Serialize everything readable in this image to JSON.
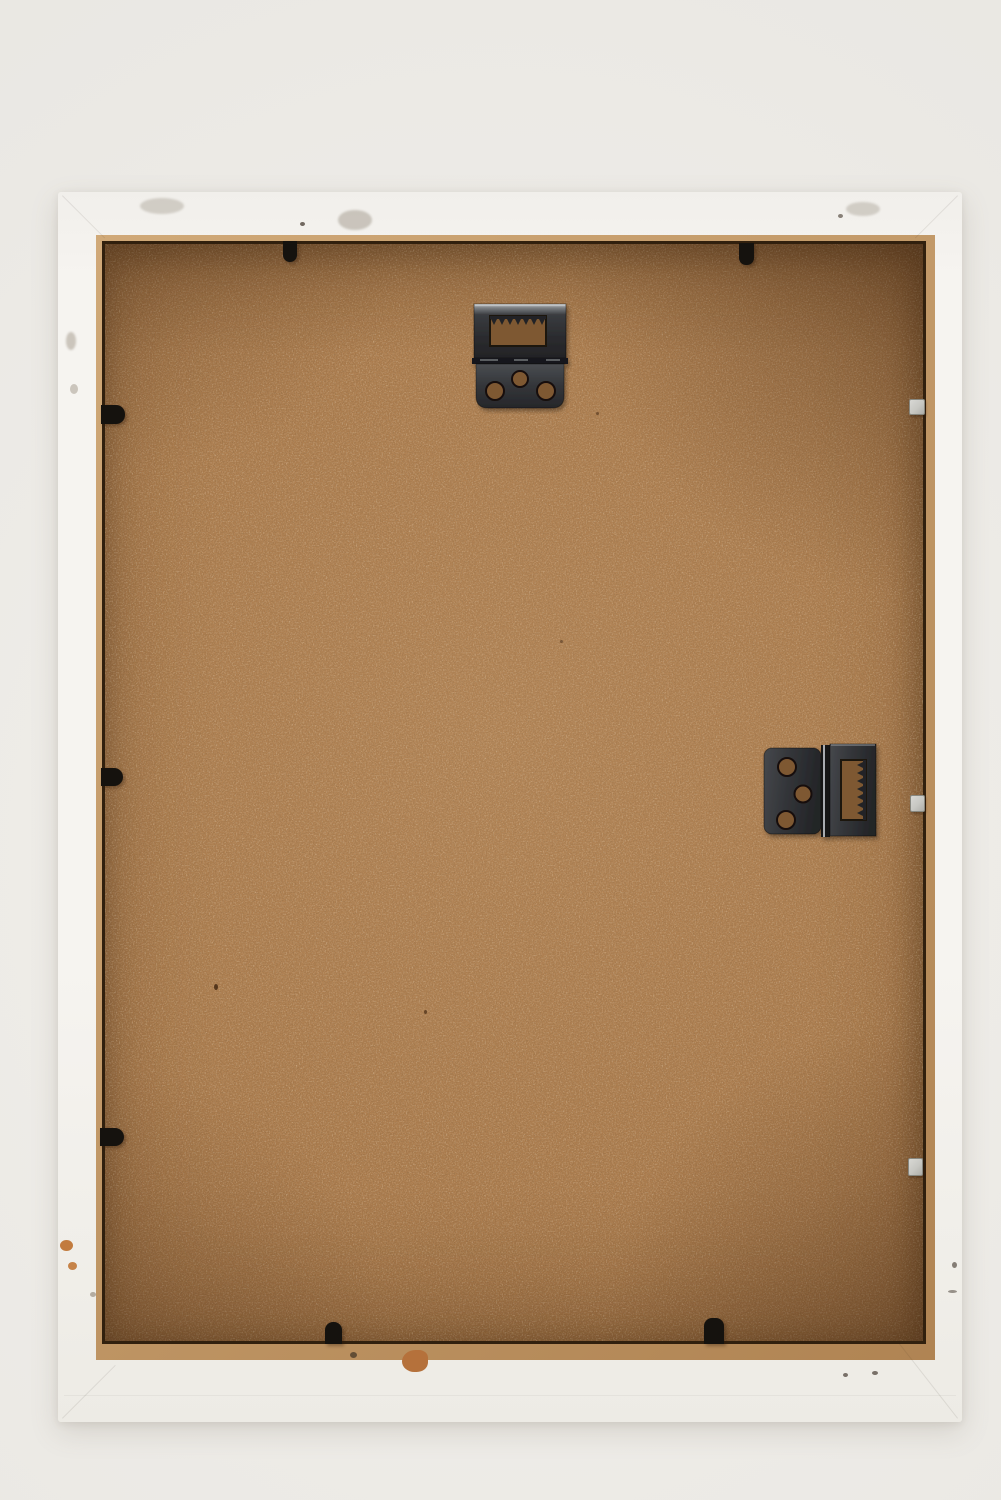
{
  "scene": {
    "type": "photograph",
    "subject": "back-of-white-picture-frame",
    "description": "Rear view of a white painted wooden picture frame with a brown hardboard backing panel, two sawtooth hinge hangers, seven black retaining clips and three silver glazing points",
    "colors": {
      "bg": "#f2f0ec",
      "bg_edge": "#e7e5e0",
      "frame": "#f6f4f0",
      "frame_shade": "#edebe5",
      "rabbet_light": "#d0a978",
      "rabbet_dark": "#b0development",
      "board": "#ac7c4d",
      "border_line": "#31200e",
      "metal_dark": "#232326",
      "metal_mid": "#35373b",
      "metal_light": "#c9cbcd",
      "hole": "#7e5833",
      "clip": "#15120e",
      "silver": "#c7c7c2",
      "chip_orange": "#c27b3e",
      "chip_brown": "#b5713b"
    },
    "hardware": {
      "hanger_count": 2,
      "hanger_type": "sawtooth-hinge-hanger",
      "top_hanger_orientation": "horizontal",
      "right_hanger_orientation": "vertical",
      "screw_holes_per_hanger": 3
    },
    "fasteners": {
      "black_clip_count": 7,
      "silver_point_count": 3
    }
  }
}
